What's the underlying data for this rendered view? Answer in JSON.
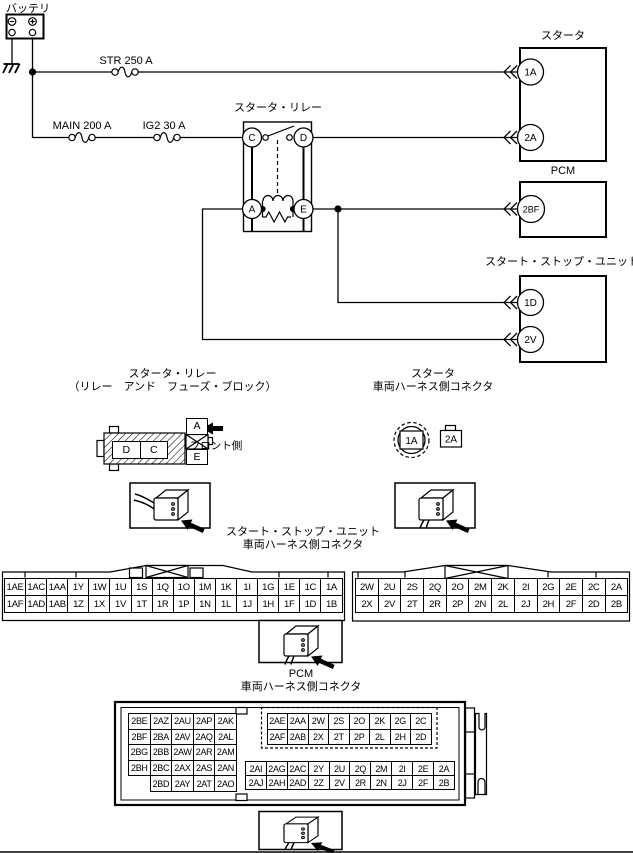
{
  "colors": {
    "line": "#000000",
    "background": "#ffffff"
  },
  "battery": {
    "label": "バッテリ"
  },
  "fuses": {
    "str": "STR 250 A",
    "main": "MAIN 200 A",
    "ig2": "IG2 30 A"
  },
  "relay": {
    "title": "スタータ・リレー",
    "c": "C",
    "d": "D",
    "a": "A",
    "e": "E"
  },
  "boxes": {
    "starter": {
      "title": "スタータ",
      "t1": "1A",
      "t2": "2A"
    },
    "pcm": {
      "title": "PCM",
      "t1": "2BF"
    },
    "ssu": {
      "title": "スタート・ストップ・ユニット",
      "t1": "1D",
      "t2": "2V"
    }
  },
  "connectors": {
    "relay": {
      "title1": "スタータ・リレー",
      "title2": "（リレー　アンド　フューズ・ブロック）",
      "d": "D",
      "c": "C",
      "a": "A",
      "e": "E",
      "front": "フロント側"
    },
    "starter": {
      "title1": "スタータ",
      "title2": "車両ハーネス側コネクタ",
      "round": "1A",
      "square": "2A"
    },
    "ssu": {
      "title1": "スタート・ストップ・ユニット",
      "title2": "車両ハーネス側コネクタ",
      "grid1": [
        [
          "1AE",
          "1AC",
          "1AA",
          "1Y",
          "1W",
          "1U",
          "1S",
          "1Q",
          "1O",
          "1M",
          "1K",
          "1I",
          "1G",
          "1E",
          "1C",
          "1A"
        ],
        [
          "1AF",
          "1AD",
          "1AB",
          "1Z",
          "1X",
          "1V",
          "1T",
          "1R",
          "1P",
          "1N",
          "1L",
          "1J",
          "1H",
          "1F",
          "1D",
          "1B"
        ]
      ],
      "grid2": [
        [
          "2W",
          "2U",
          "2S",
          "2Q",
          "2O",
          "2M",
          "2K",
          "2I",
          "2G",
          "2E",
          "2C",
          "2A"
        ],
        [
          "2X",
          "2V",
          "2T",
          "2R",
          "2P",
          "2N",
          "2L",
          "2J",
          "2H",
          "2F",
          "2D",
          "2B"
        ]
      ]
    },
    "pcm": {
      "title1": "PCM",
      "title2": "車両ハーネス側コネクタ",
      "left_grid": [
        [
          "2BE",
          "2AZ",
          "2AU",
          "2AP",
          "2AK"
        ],
        [
          "2BF",
          "2BA",
          "2AV",
          "2AQ",
          "2AL"
        ],
        [
          "2BG",
          "2BB",
          "2AW",
          "2AR",
          "2AM"
        ],
        [
          "2BH",
          "2BC",
          "2AX",
          "2AS",
          "2AN"
        ],
        [
          "",
          "2BD",
          "2AY",
          "2AT",
          "2AO"
        ]
      ],
      "top_right_grid": [
        [
          "2AE",
          "2AA",
          "2W",
          "2S",
          "2O",
          "2K",
          "2G",
          "2C"
        ],
        [
          "2AF",
          "2AB",
          "2X",
          "2T",
          "2P",
          "2L",
          "2H",
          "2D"
        ]
      ],
      "bottom_right_grid": [
        [
          "2AI",
          "2AG",
          "2AC",
          "2Y",
          "2U",
          "2Q",
          "2M",
          "2I",
          "2E",
          "2A"
        ],
        [
          "2AJ",
          "2AH",
          "2AD",
          "2Z",
          "2V",
          "2R",
          "2N",
          "2J",
          "2F",
          "2B"
        ]
      ]
    }
  }
}
